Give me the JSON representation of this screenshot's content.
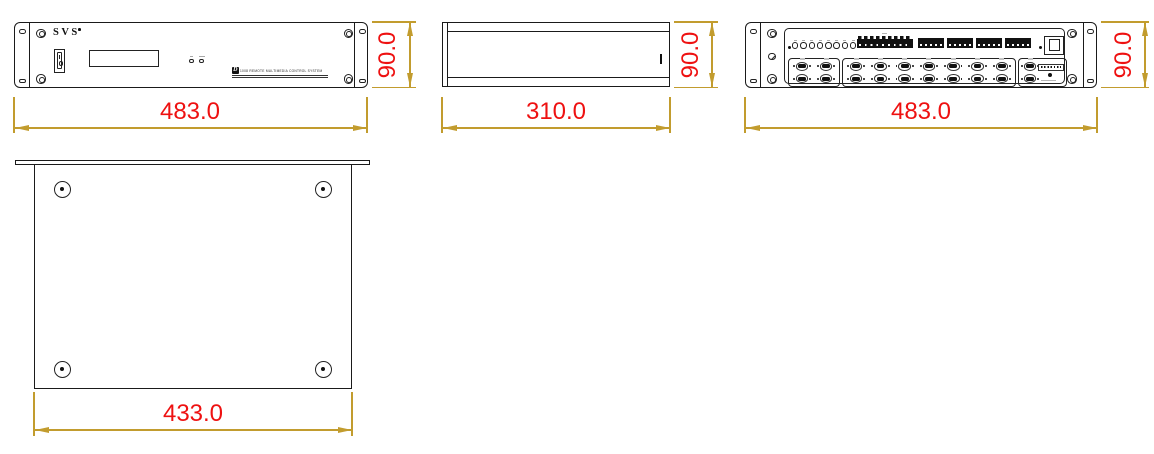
{
  "colors": {
    "dim_line": "#C29C2E",
    "dim_text": "#EE1111",
    "line": "#1A1A1A"
  },
  "front": {
    "brand": "SVS",
    "model_prefix": "D",
    "model_text": "1008 REMOTE MULTIMEDIA CONTROL SYSTEM",
    "width_dim": "483.0",
    "height_dim": "90.0"
  },
  "side": {
    "width_dim": "310.0",
    "height_dim": "90.0"
  },
  "rear": {
    "width_dim": "483.0",
    "height_dim": "90.0",
    "ir_port_count": 8,
    "terminal_segment_count": 4,
    "db9_group1_count": 4,
    "db9_group2_count": 14,
    "db9_group3_count": 2
  },
  "top": {
    "width_dim": "433.0"
  }
}
